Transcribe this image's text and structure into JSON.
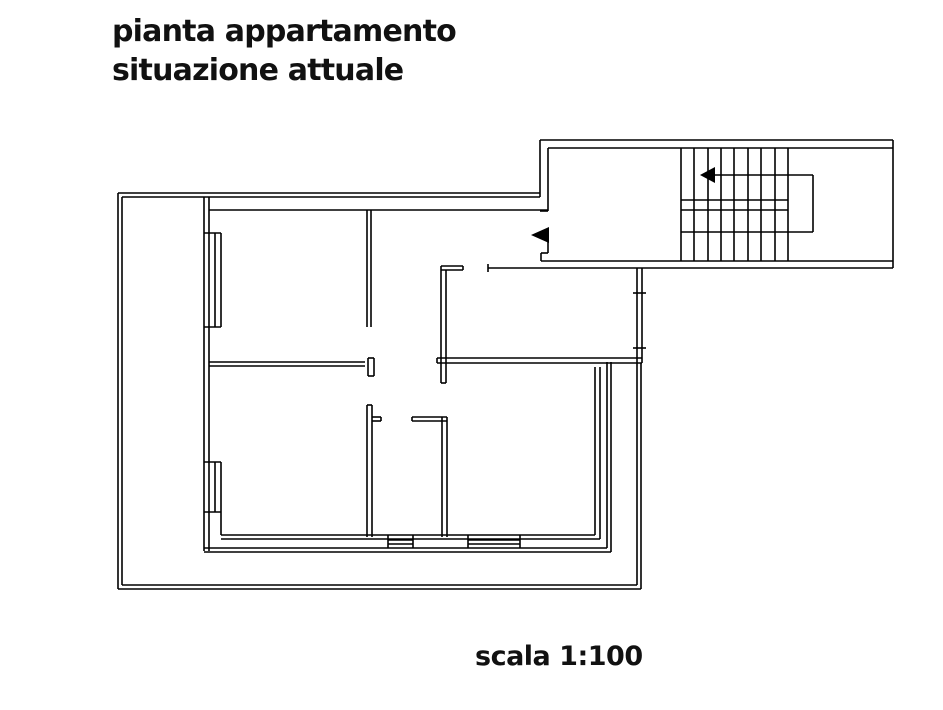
{
  "page": {
    "background_color": "#ffffff",
    "line_color": "#000000",
    "text_color": "#111111"
  },
  "title": {
    "line1": "pianta appartamento",
    "line2": "situazione attuale"
  },
  "scale_label": "scala 1:100",
  "drawing": {
    "width": 943,
    "height": 710,
    "stroke_width": 1.6,
    "line_color": "#000000",
    "segments": [
      [
        118,
        193,
        540,
        193
      ],
      [
        122,
        197,
        540,
        197
      ],
      [
        118,
        193,
        118,
        589
      ],
      [
        122,
        197,
        122,
        585
      ],
      [
        118,
        589,
        641,
        589
      ],
      [
        122,
        585,
        637,
        585
      ],
      [
        641,
        363,
        641,
        589
      ],
      [
        637,
        363,
        637,
        585
      ],
      [
        204,
        197,
        204,
        551
      ],
      [
        209,
        197,
        209,
        551
      ],
      [
        204,
        233,
        221,
        233
      ],
      [
        204,
        327,
        221,
        327
      ],
      [
        215,
        233,
        215,
        327
      ],
      [
        221,
        233,
        221,
        327
      ],
      [
        204,
        462,
        221,
        462
      ],
      [
        204,
        512,
        221,
        512
      ],
      [
        215,
        462,
        215,
        512
      ],
      [
        221,
        462,
        221,
        535
      ],
      [
        209,
        210,
        548,
        210
      ],
      [
        367,
        210,
        367,
        327
      ],
      [
        371,
        210,
        371,
        327
      ],
      [
        209,
        362,
        365,
        362
      ],
      [
        209,
        366,
        365,
        366
      ],
      [
        368,
        358,
        374,
        358
      ],
      [
        374,
        358,
        374,
        376
      ],
      [
        368,
        376,
        374,
        376
      ],
      [
        368,
        358,
        368,
        376
      ],
      [
        367,
        405,
        367,
        537
      ],
      [
        372,
        405,
        372,
        537
      ],
      [
        367,
        405,
        372,
        405
      ],
      [
        372,
        417,
        381,
        417
      ],
      [
        372,
        421,
        381,
        421
      ],
      [
        381,
        417,
        381,
        421
      ],
      [
        412,
        417,
        447,
        417
      ],
      [
        412,
        421,
        447,
        421
      ],
      [
        412,
        417,
        412,
        421
      ],
      [
        442,
        417,
        442,
        537
      ],
      [
        447,
        417,
        447,
        537
      ],
      [
        441,
        266,
        441,
        383
      ],
      [
        446,
        270,
        446,
        383
      ],
      [
        441,
        383,
        446,
        383
      ],
      [
        441,
        266,
        463,
        266
      ],
      [
        441,
        270,
        463,
        270
      ],
      [
        463,
        266,
        463,
        270
      ],
      [
        488,
        264,
        488,
        272
      ],
      [
        637,
        268,
        637,
        363
      ],
      [
        642,
        268,
        642,
        363
      ],
      [
        633,
        293,
        646,
        293
      ],
      [
        633,
        348,
        646,
        348
      ],
      [
        437,
        358,
        642,
        358
      ],
      [
        437,
        363,
        642,
        363
      ],
      [
        437,
        358,
        437,
        363
      ],
      [
        540,
        140,
        893,
        140
      ],
      [
        893,
        140,
        893,
        268
      ],
      [
        540,
        140,
        540,
        197
      ],
      [
        488,
        268,
        893,
        268
      ],
      [
        548,
        148,
        893,
        148
      ],
      [
        541,
        261,
        893,
        261
      ],
      [
        548,
        148,
        548,
        211
      ],
      [
        540,
        211,
        548,
        211
      ],
      [
        548,
        240,
        548,
        253
      ],
      [
        541,
        253,
        548,
        253
      ],
      [
        541,
        253,
        541,
        261
      ],
      [
        681,
        148,
        681,
        261
      ],
      [
        694,
        148,
        694,
        261
      ],
      [
        708,
        148,
        708,
        261
      ],
      [
        721,
        148,
        721,
        261
      ],
      [
        734,
        148,
        734,
        261
      ],
      [
        748,
        148,
        748,
        261
      ],
      [
        761,
        148,
        761,
        261
      ],
      [
        775,
        148,
        775,
        261
      ],
      [
        788,
        148,
        788,
        261
      ],
      [
        681,
        200,
        788,
        200
      ],
      [
        681,
        210,
        788,
        210
      ],
      [
        710,
        175,
        813,
        175
      ],
      [
        813,
        175,
        813,
        232
      ],
      [
        681,
        232,
        813,
        232
      ],
      [
        595,
        367,
        595,
        535
      ],
      [
        600,
        367,
        600,
        539
      ],
      [
        607,
        362,
        607,
        548
      ],
      [
        611,
        362,
        611,
        552
      ],
      [
        221,
        535,
        595,
        535
      ],
      [
        221,
        539,
        600,
        539
      ],
      [
        204,
        548,
        607,
        548
      ],
      [
        204,
        552,
        611,
        552
      ],
      [
        388,
        535,
        388,
        548
      ],
      [
        413,
        535,
        413,
        548
      ],
      [
        388,
        540,
        413,
        540
      ],
      [
        388,
        544,
        413,
        544
      ],
      [
        468,
        535,
        468,
        548
      ],
      [
        520,
        535,
        520,
        548
      ],
      [
        468,
        540,
        520,
        540
      ],
      [
        468,
        544,
        520,
        544
      ]
    ],
    "arrows": [
      {
        "name": "stair-direction-arrow",
        "points": [
          [
            700,
            175
          ],
          [
            715,
            167
          ],
          [
            715,
            183
          ]
        ]
      },
      {
        "name": "entrance-direction-arrow",
        "points": [
          [
            531,
            235
          ],
          [
            549,
            227
          ],
          [
            549,
            243
          ]
        ]
      }
    ]
  }
}
